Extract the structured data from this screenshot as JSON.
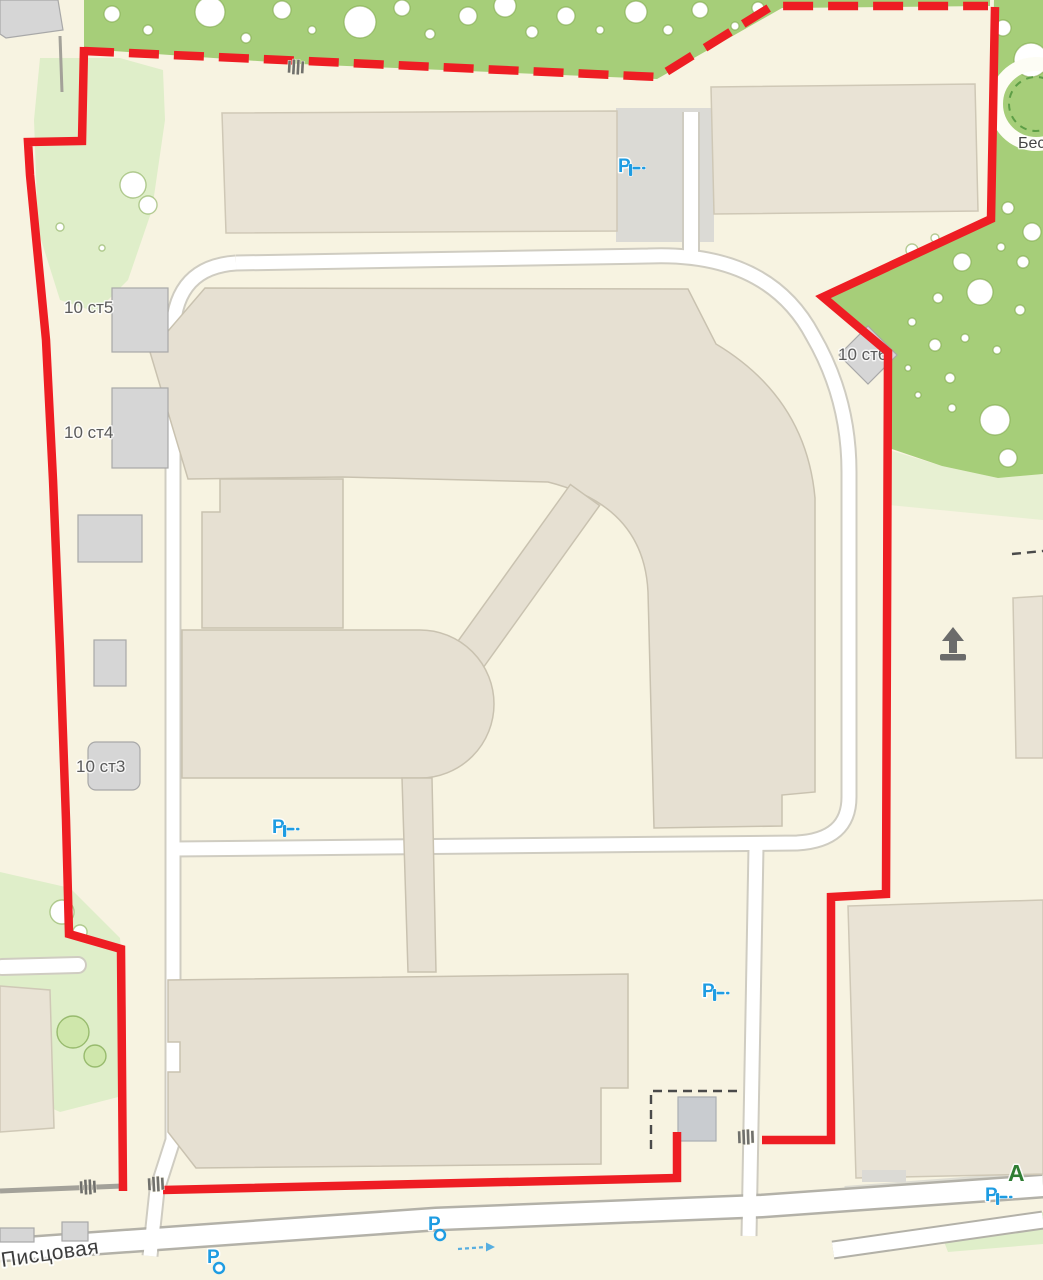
{
  "map": {
    "labels": {
      "building_10s5": "10 ст5",
      "building_10s4": "10 ст4",
      "building_10s3": "10 ст3",
      "building_10s6": "10 ст6",
      "street": "Писцовая",
      "greenery_area_partial": "Бес",
      "bus_stop": "А",
      "parking_letter": "P"
    },
    "colors": {
      "background": "#f7f3e1",
      "greenery": "#a6ce79",
      "greenery_pale": "#dfeec9",
      "building_beige": "#e9e3d5",
      "building_complex": "#e6e0d2",
      "building_gray": "#d6d6d6",
      "road_fill": "#ffffff",
      "boundary_red": "#ee1d23",
      "parking_blue": "#1e9ce2",
      "bus_stop_green": "#2f7d33"
    },
    "icons": {
      "parking_barrier": "parking-with-barrier",
      "parking_paid": "paid-street-parking",
      "gate": "fence-gate",
      "entrance": "entrance-arrow",
      "one_way": "one-way-arrow",
      "gazebo": "gazebo-path-circle"
    }
  }
}
